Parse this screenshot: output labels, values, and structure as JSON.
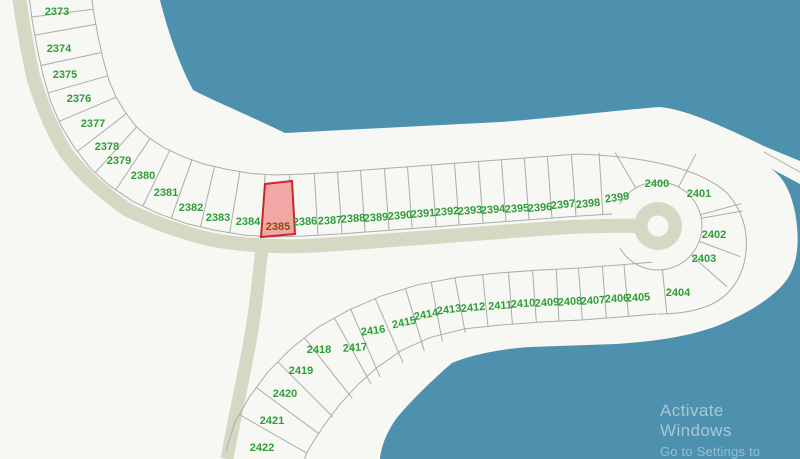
{
  "map": {
    "highlighted_lot": "2385",
    "lots": [
      "2373",
      "2374",
      "2375",
      "2376",
      "2377",
      "2378",
      "2379",
      "2380",
      "2381",
      "2382",
      "2383",
      "2384",
      "2385",
      "2386",
      "2387",
      "2388",
      "2389",
      "2390",
      "2391",
      "2392",
      "2393",
      "2394",
      "2395",
      "2396",
      "2397",
      "2398",
      "2399",
      "2400",
      "2401",
      "2402",
      "2403",
      "2404",
      "2405",
      "2406",
      "2407",
      "2408",
      "2409",
      "2410",
      "2411",
      "2412",
      "2413",
      "2414",
      "2415",
      "2416",
      "2417",
      "2418",
      "2419",
      "2420",
      "2421",
      "2422"
    ],
    "colors": {
      "water": "#4d91ae",
      "land": "#f7f7f4",
      "road": "#d6d8c4",
      "lot_line": "#a8aeab",
      "lot_label": "#2f9e38",
      "highlight_fill": "#f2a6a6",
      "highlight_stroke": "#cc2727",
      "highlight_label": "#8a4a00",
      "coast_line": "#b5bab6"
    }
  },
  "watermark": {
    "line1": "Activate Windows",
    "line2": "Go to Settings to activate"
  }
}
